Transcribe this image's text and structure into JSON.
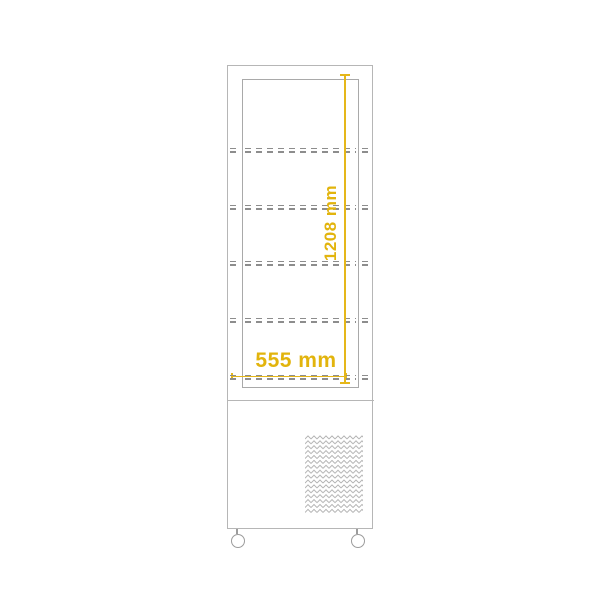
{
  "diagram": {
    "title": "upright-display-cabinet-dimension-drawing",
    "dimensions": {
      "height_label": "1208 mm",
      "width_label": "555 mm"
    },
    "shelf_count": 5,
    "colors": {
      "dimension_accent": "#e2b40d",
      "outline_gray": "#b6b6b6",
      "shelf_dash_gray": "#8d8d8d",
      "background": "#ffffff"
    }
  }
}
